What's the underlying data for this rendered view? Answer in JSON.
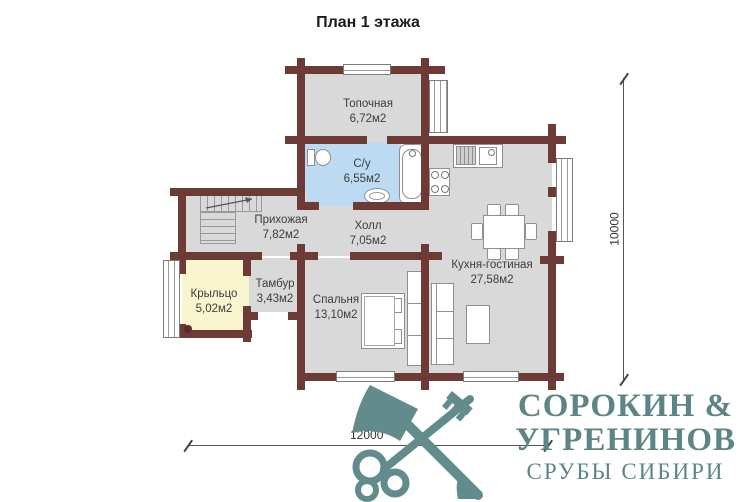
{
  "title": "План 1 этажа",
  "plan": {
    "rooms": [
      {
        "name": "Топочная",
        "area": "6,72м2"
      },
      {
        "name": "С/у",
        "area": "6,55м2"
      },
      {
        "name": "Прихожая",
        "area": "7,82м2"
      },
      {
        "name": "Холл",
        "area": "7,05м2"
      },
      {
        "name": "Кухня-гостиная",
        "area": "27,58м2"
      },
      {
        "name": "Тамбур",
        "area": "3,43м2"
      },
      {
        "name": "Крыльцо",
        "area": "5,02м2"
      },
      {
        "name": "Спальня",
        "area": "13,10м2"
      }
    ],
    "dimensions": {
      "bottom": "12000",
      "right": "10000"
    },
    "colors": {
      "wall": "#6e3a35",
      "floor": "#d9d9d9",
      "bathroom_floor": "#bcdbf2",
      "porch_floor": "#f8f5cf",
      "logo": "#5d8585"
    }
  },
  "logo": {
    "line1": "СОРОКИН &",
    "line2": "УГРЕНИНОВ",
    "line3": "СРУБЫ СИБИРИ",
    "icons": [
      "axe-icon",
      "key-icon"
    ]
  }
}
